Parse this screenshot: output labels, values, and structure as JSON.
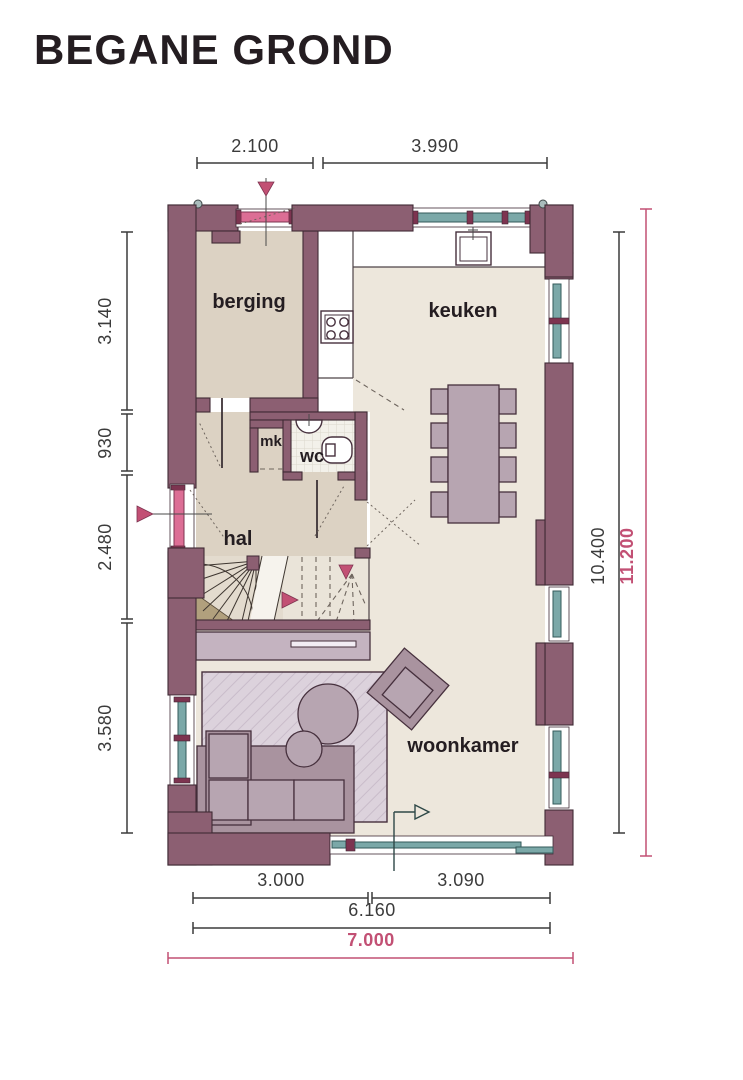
{
  "title": "BEGANE GROND",
  "rooms": {
    "berging": "berging",
    "keuken": "keuken",
    "mk": "mk",
    "wc": "wc",
    "hal": "hal",
    "woonkamer": "woonkamer"
  },
  "dimensions": {
    "top": [
      "2.100",
      "3.990"
    ],
    "left": [
      "3.140",
      "930",
      "2.480",
      "3.580"
    ],
    "right_inner": "10.400",
    "right_outer": "11.200",
    "bottom_upper": [
      "3.000",
      "3.090"
    ],
    "bottom_middle": "6.160",
    "bottom_total": "7.000"
  },
  "colors": {
    "ink": "#241d21",
    "dimInk": "#3b3b3b",
    "accent": "#c25074",
    "accentSoft": "#dc6e95",
    "wall": "#8c5f72",
    "wallStroke": "#402a35",
    "window": "#7ba8a8",
    "windowDeep": "#335a5a",
    "frameCap": "#7d3450",
    "floorWarm": "#dcd2c3",
    "floorLight": "#ede7dc",
    "counter": "#ffffff",
    "furn": "#b7a5b1",
    "furnDark": "#a9939f",
    "furnStroke": "#46303d",
    "rug": "#dcd2dc",
    "rugLine": "#c9bcca",
    "sideboard": "#c4b3c0",
    "tile": "#f3f1ea",
    "tileLine": "#dbd7cc",
    "stairsBg": "#e3dbce",
    "stairsBgLight": "#eae4d9",
    "wedge": "#b1a07d",
    "lineSoft": "#6e655e"
  }
}
